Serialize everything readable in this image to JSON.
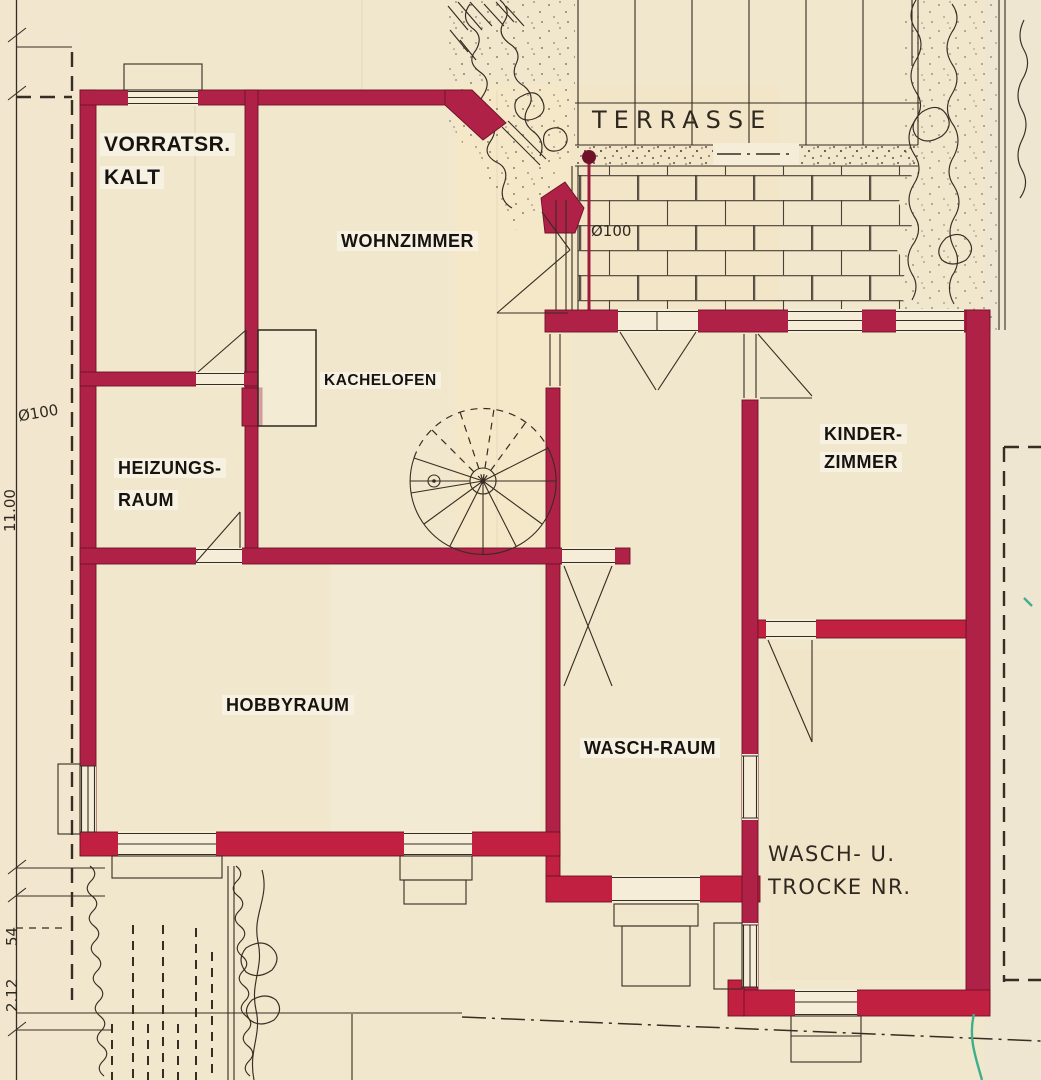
{
  "document": {
    "type": "architectural floor plan (basement level), scanned drawing with red ink walls"
  },
  "colors": {
    "paper": "#f1e7cc",
    "paperLight": "#f5edd8",
    "wall": "#af2147",
    "wallDark": "#6e1129",
    "wallBright": "#c22040",
    "line": "#362d23",
    "redLine": "#9c1a3c",
    "greenMark": "#3fae8c"
  },
  "rooms": {
    "vorratsraum": {
      "line1": "VORRATSR.",
      "line2": "KALT"
    },
    "wohnzimmer": {
      "label": "WOHNZIMMER"
    },
    "heizungsraum": {
      "line1": "HEIZUNGS-",
      "line2": "RAUM"
    },
    "hobbyraum": {
      "label": "HOBBYRAUM"
    },
    "waschraum": {
      "label": "WASCH-RAUM"
    },
    "kinderzimmer": {
      "line1": "KINDER-",
      "line2": "ZIMMER"
    },
    "waschtrockenraum": {
      "line1": "WASCH- U.",
      "line2": "TROCKE NR."
    },
    "terrasse": {
      "label": "TERRASSE"
    }
  },
  "annotations": {
    "kachelofen": {
      "label": "KACHELOFEN"
    },
    "pipe_terrace": {
      "label": "Ø100"
    },
    "pipe_left": {
      "label": "Ø100"
    },
    "dim_a": "2.12",
    "dim_b": "54",
    "dim_c": "11.00"
  }
}
